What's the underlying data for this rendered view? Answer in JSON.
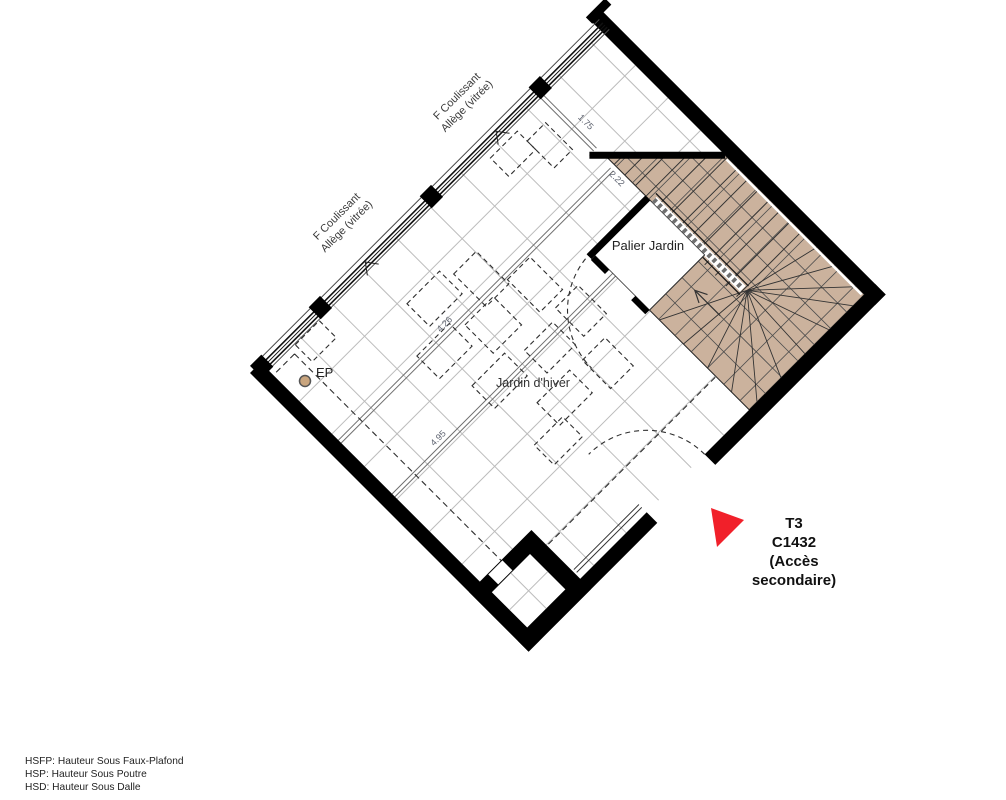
{
  "plan_labels": {
    "palier_jardin": "Palier Jardin",
    "jardin_dhiver": "Jardin d'hiver",
    "ep": "EP"
  },
  "window_labels": [
    {
      "line1": "F Coulissant",
      "line2": "Allège (vitrée)"
    },
    {
      "line1": "F Coulissant",
      "line2": "Allège (vitrée)"
    }
  ],
  "dimensions": [
    "1.75",
    "2.22",
    "4.26",
    "4.95"
  ],
  "unit_marker": {
    "lines": [
      "T3",
      "C1432",
      "(Accès",
      "secondaire)"
    ]
  },
  "legend": {
    "lines": [
      "HSFP: Hauteur Sous Faux-Plafond",
      "HSP: Hauteur Sous Poutre",
      "HSD: Hauteur Sous Dalle"
    ]
  },
  "colors": {
    "stair_fill": "#cbb29d",
    "marker_red": "#f1202a",
    "ep_dot": "#c9a57e",
    "grid_gray": "#bcbcbc",
    "wall_black": "#000000"
  }
}
